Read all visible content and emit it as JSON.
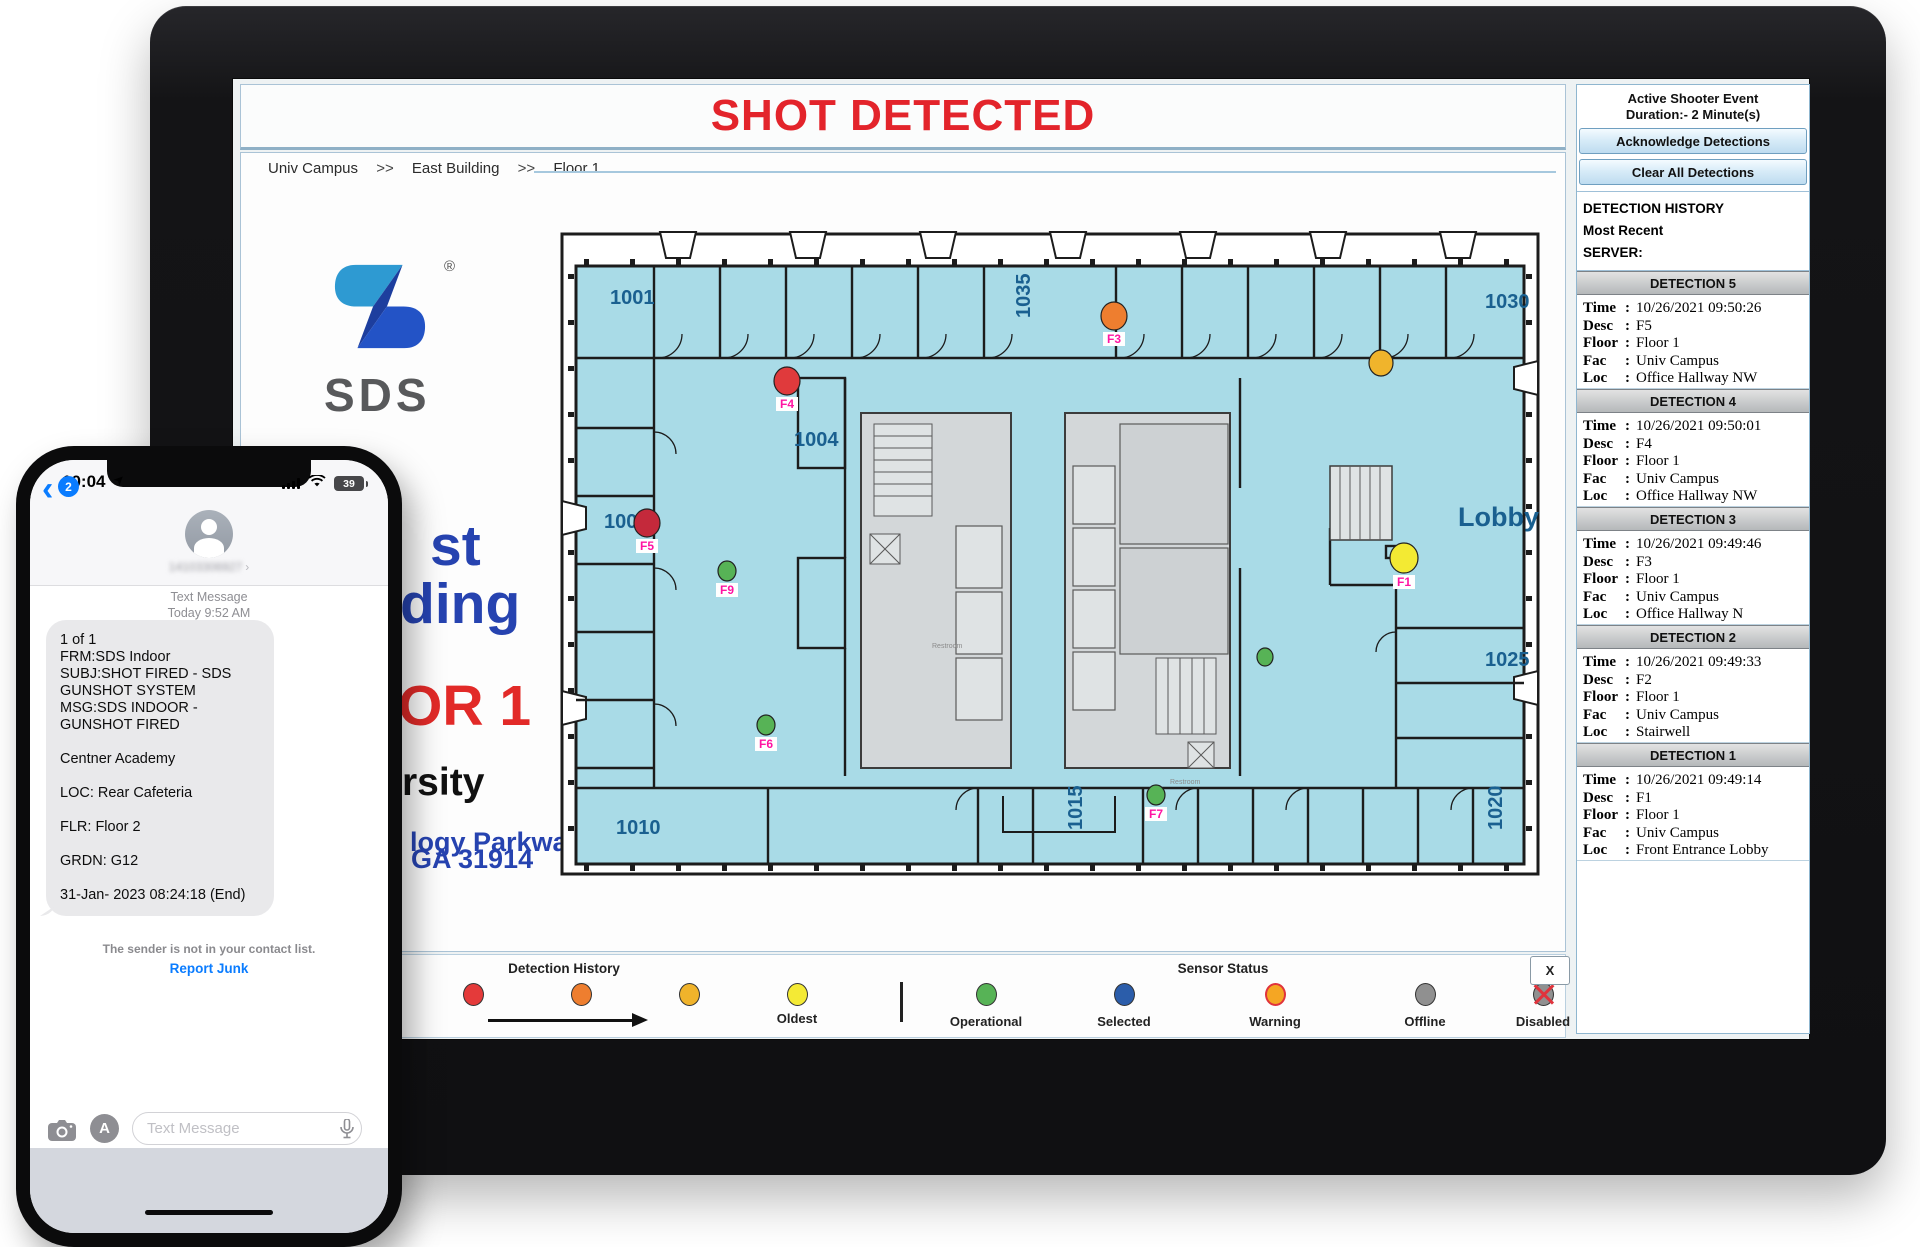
{
  "monitor": {
    "alert_banner": "SHOT DETECTED",
    "breadcrumb": {
      "separator": ">>",
      "items": [
        "Univ Campus",
        "East Building",
        "Floor 1"
      ]
    },
    "info": {
      "logo_text": "SDS",
      "registered": "®",
      "fragments": {
        "line1": "st",
        "line2": "ding",
        "floor": "OR 1",
        "univ": "rsity",
        "addr1": "logy Parkway",
        "addr2": ", GA 31914"
      }
    },
    "floorplan": {
      "label_color": "#1a6090",
      "marker_label_color": "#ff14a3",
      "rooms": [
        {
          "label": "1001",
          "x": 52,
          "y": 76
        },
        {
          "label": "1035",
          "x": 472,
          "y": 90,
          "rot": -90
        },
        {
          "label": "1030",
          "x": 927,
          "y": 80
        },
        {
          "label": "1004",
          "x": 236,
          "y": 218
        },
        {
          "label": "1005",
          "x": 46,
          "y": 300
        },
        {
          "label": "1025",
          "x": 927,
          "y": 438
        },
        {
          "label": "1010",
          "x": 58,
          "y": 606
        },
        {
          "label": "1015",
          "x": 524,
          "y": 602,
          "rot": -90
        },
        {
          "label": "1020",
          "x": 944,
          "y": 602,
          "rot": -90
        },
        {
          "label": "Lobby",
          "x": 900,
          "y": 298,
          "size": 27
        },
        {
          "label": "Restroom",
          "x": 374,
          "y": 420,
          "size": 7,
          "muted": true
        },
        {
          "label": "Restroom",
          "x": 612,
          "y": 556,
          "size": 7,
          "muted": true
        }
      ],
      "detections": [
        {
          "id": "F3",
          "label": "F3",
          "x": 556,
          "y": 88,
          "color": "#ee7e2f",
          "r": 14
        },
        {
          "id": "sensor-amber",
          "label": "",
          "x": 823,
          "y": 135,
          "color": "#f0b42c",
          "r": 13
        },
        {
          "id": "F4",
          "label": "F4",
          "x": 229,
          "y": 153,
          "color": "#e03a3c",
          "r": 14
        },
        {
          "id": "F5",
          "label": "F5",
          "x": 89,
          "y": 295,
          "color": "#c4293b",
          "r": 14
        },
        {
          "id": "F9",
          "label": "F9",
          "x": 169,
          "y": 343,
          "color": "#57b356",
          "r": 10
        },
        {
          "id": "F6",
          "label": "F6",
          "x": 208,
          "y": 497,
          "color": "#57b356",
          "r": 10
        },
        {
          "id": "F7",
          "label": "F7",
          "x": 598,
          "y": 567,
          "color": "#57b356",
          "r": 10
        },
        {
          "id": "sensor-green",
          "label": "",
          "x": 707,
          "y": 429,
          "color": "#57b356",
          "r": 9
        },
        {
          "id": "F1",
          "label": "F1",
          "x": 846,
          "y": 330,
          "color": "#f3ea33",
          "r": 15
        }
      ]
    },
    "legend": {
      "history": {
        "title": "Detection History",
        "dots": [
          "#e43a3a",
          "#ee7e2f",
          "#f0b32b",
          "#f4ea35"
        ],
        "oldest_label": "Oldest"
      },
      "sensor": {
        "title": "Sensor Status",
        "items": [
          {
            "label": "Operational",
            "color": "#57b356"
          },
          {
            "label": "Selected",
            "color": "#2b5daa"
          },
          {
            "label": "Warning",
            "color": "#f5a623",
            "ring": true
          },
          {
            "label": "Offline",
            "color": "#909090"
          },
          {
            "label": "Disabled",
            "color": "#909090",
            "cross": true
          }
        ]
      },
      "close_label": "X"
    },
    "sidebar": {
      "event_title": "Active Shooter Event",
      "event_duration": "Duration:- 2 Minute(s)",
      "acknowledge_button": "Acknowledge Detections",
      "clear_button": "Clear All Detections",
      "history_title": "DETECTION HISTORY",
      "history_subtitle": "Most Recent",
      "server_label": "SERVER:",
      "field_labels": [
        "Time",
        "Desc",
        "Floor",
        "Fac",
        "Loc"
      ],
      "detections": [
        {
          "title": "DETECTION 5",
          "time": "10/26/2021 09:50:26",
          "desc": "F5",
          "floor": "Floor 1",
          "fac": "Univ Campus",
          "loc": "Office Hallway NW"
        },
        {
          "title": "DETECTION 4",
          "time": "10/26/2021 09:50:01",
          "desc": "F4",
          "floor": "Floor 1",
          "fac": "Univ Campus",
          "loc": "Office Hallway NW"
        },
        {
          "title": "DETECTION 3",
          "time": "10/26/2021 09:49:46",
          "desc": "F3",
          "floor": "Floor 1",
          "fac": "Univ Campus",
          "loc": "Office Hallway N"
        },
        {
          "title": "DETECTION 2",
          "time": "10/26/2021 09:49:33",
          "desc": "F2",
          "floor": "Floor 1",
          "fac": "Univ Campus",
          "loc": "Stairwell"
        },
        {
          "title": "DETECTION 1",
          "time": "10/26/2021 09:49:14",
          "desc": "F1",
          "floor": "Floor 1",
          "fac": "Univ Campus",
          "loc": "Front Entrance Lobby"
        }
      ]
    }
  },
  "phone": {
    "status": {
      "time": "10:04",
      "battery": "39"
    },
    "nav": {
      "back_chevron": "‹",
      "back_badge": "2",
      "contact": "14103306927",
      "forward_chevron": "›"
    },
    "conversation": {
      "header_service": "Text Message",
      "header_date": "Today 9:52 AM",
      "message_lines": [
        "1 of 1",
        "FRM:SDS Indoor",
        "SUBJ:SHOT FIRED - SDS",
        "GUNSHOT SYSTEM",
        "MSG:SDS INDOOR -",
        "GUNSHOT FIRED",
        "",
        "Centner Academy",
        "",
        "LOC: Rear Cafeteria",
        "",
        "FLR: Floor 2",
        "",
        "GRDN: G12",
        "",
        "31-Jan- 2023 08:24:18 (End)"
      ],
      "junk_notice": "The sender is not in your contact list.",
      "report_junk": "Report Junk"
    },
    "composer": {
      "placeholder": "Text Message"
    }
  }
}
